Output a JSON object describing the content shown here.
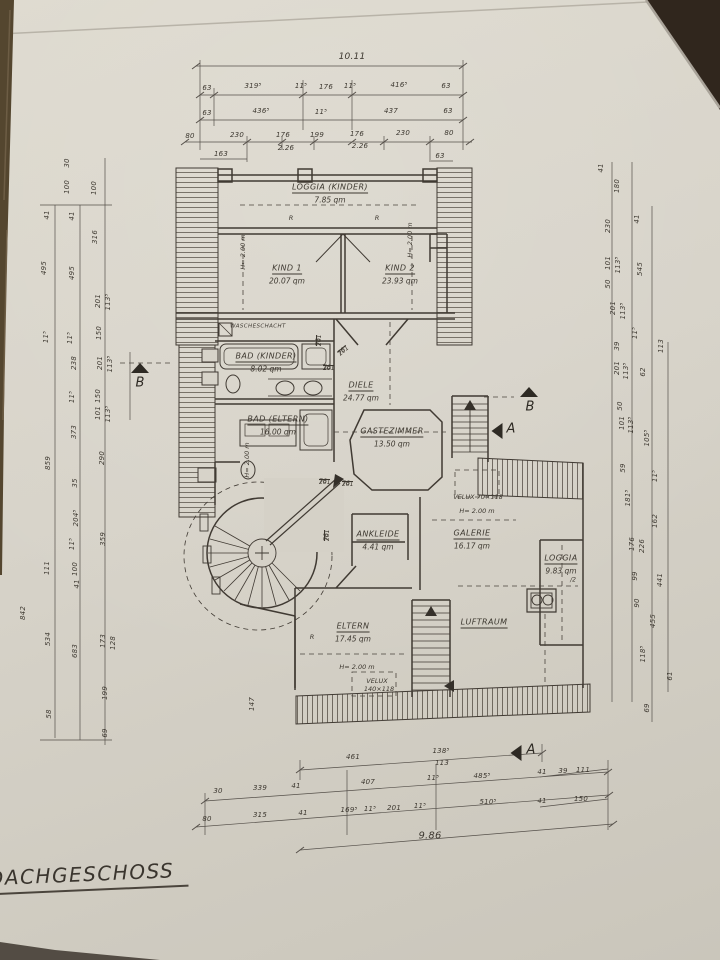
{
  "title": {
    "label": "DACHGESCHOSS"
  },
  "palette": {
    "paper": "#d7d3c9",
    "ink": "#403a33",
    "dim_ink": "#4f4941",
    "wood": "#54462f",
    "corner": "#30261d"
  },
  "rooms": [
    {
      "n": "LOGGIA (KINDER)",
      "a": "7.85 qm",
      "x": 330,
      "y": 188
    },
    {
      "n": "KIND 1",
      "a": "20.07 qm",
      "x": 287,
      "y": 269
    },
    {
      "n": "KIND 2",
      "a": "23.93 qm",
      "x": 400,
      "y": 269
    },
    {
      "n": "WASCHESCHACHT",
      "x": 258,
      "y": 327,
      "s": 5.5,
      "nou": true
    },
    {
      "n": "BAD (KINDER)",
      "a": "8.02 qm",
      "x": 266,
      "y": 357
    },
    {
      "n": "BAD (ELTERN)",
      "a": "16.00 qm",
      "x": 278,
      "y": 420
    },
    {
      "n": "DIELE",
      "a": "24.77 qm",
      "x": 361,
      "y": 386
    },
    {
      "n": "GASTEZIMMER",
      "a": "13.50 qm",
      "x": 392,
      "y": 432
    },
    {
      "n": "ANKLEIDE",
      "a": "4.41 qm",
      "x": 378,
      "y": 535
    },
    {
      "n": "GALERIE",
      "a": "16.17 qm",
      "x": 472,
      "y": 534
    },
    {
      "n": "LOGGIA",
      "a": "9.83 qm",
      "a2": "/2",
      "x": 561,
      "y": 559
    },
    {
      "n": "ELTERN",
      "a": "17.45 qm",
      "x": 353,
      "y": 627
    },
    {
      "n": "LUFTRAUM",
      "x": 484,
      "y": 623
    }
  ],
  "door_dim": {
    "num": "76",
    "den": "201"
  },
  "door_fractions": [
    {
      "x": 316,
      "y": 346,
      "r": 1
    },
    {
      "x": 323,
      "y": 365,
      "r": 0
    },
    {
      "x": 337,
      "y": 352,
      "r": 2
    },
    {
      "x": 319,
      "y": 479,
      "r": 0
    },
    {
      "x": 342,
      "y": 481,
      "r": 0
    },
    {
      "x": 324,
      "y": 541,
      "r": 1
    }
  ],
  "notes": [
    {
      "t": "VELUX 70×118",
      "x": 478,
      "y": 497
    },
    {
      "t": "H= 2.00 m",
      "x": 477,
      "y": 511
    },
    {
      "t": "H= 2.00 m",
      "x": 357,
      "y": 667
    },
    {
      "t": "VELUX",
      "x": 377,
      "y": 681
    },
    {
      "t": "140×118",
      "x": 379,
      "y": 689
    },
    {
      "t": "H= 2.00 m",
      "x": 243,
      "y": 252,
      "r": 1
    },
    {
      "t": "H= 2.00 m",
      "x": 410,
      "y": 240,
      "r": 1
    },
    {
      "t": "H= 2.00 m",
      "x": 247,
      "y": 460,
      "r": 1
    },
    {
      "t": "R",
      "x": 291,
      "y": 218
    },
    {
      "t": "R",
      "x": 377,
      "y": 218
    },
    {
      "t": "R",
      "x": 312,
      "y": 637
    }
  ],
  "dim_labels": [
    [
      "10.11",
      352,
      57,
      0,
      9
    ],
    [
      "63",
      207,
      88
    ],
    [
      "319⁵",
      253,
      86
    ],
    [
      "11⁵",
      301,
      86
    ],
    [
      "176",
      326,
      87
    ],
    [
      "11⁵",
      350,
      86
    ],
    [
      "416⁵",
      399,
      85
    ],
    [
      "63",
      446,
      86
    ],
    [
      "63",
      207,
      113
    ],
    [
      "436⁵",
      261,
      111
    ],
    [
      "11⁵",
      321,
      112
    ],
    [
      "437",
      391,
      111
    ],
    [
      "63",
      448,
      111
    ],
    [
      "80",
      190,
      136
    ],
    [
      "230",
      237,
      135
    ],
    [
      "176",
      283,
      135
    ],
    [
      "199",
      317,
      135
    ],
    [
      "176",
      357,
      134
    ],
    [
      "230",
      403,
      133
    ],
    [
      "80",
      449,
      133
    ],
    [
      "2.26",
      286,
      148
    ],
    [
      "2.26",
      360,
      146
    ],
    [
      "163",
      221,
      154
    ],
    [
      "63",
      440,
      156
    ],
    [
      "461",
      353,
      757
    ],
    [
      "138⁵",
      441,
      751
    ],
    [
      "113",
      442,
      763
    ],
    [
      "30",
      218,
      791
    ],
    [
      "339",
      260,
      788
    ],
    [
      "41",
      296,
      786
    ],
    [
      "407",
      368,
      782
    ],
    [
      "11⁵",
      433,
      778
    ],
    [
      "485⁵",
      482,
      776
    ],
    [
      "41",
      542,
      772
    ],
    [
      "39",
      563,
      771
    ],
    [
      "111",
      583,
      770
    ],
    [
      "80",
      207,
      819
    ],
    [
      "315",
      260,
      815
    ],
    [
      "41",
      303,
      813
    ],
    [
      "169⁵",
      349,
      810
    ],
    [
      "11⁵",
      370,
      809
    ],
    [
      "201",
      394,
      808
    ],
    [
      "11⁵",
      420,
      806
    ],
    [
      "510⁵",
      488,
      802
    ],
    [
      "41",
      542,
      801
    ],
    [
      "150",
      581,
      799
    ],
    [
      "9.86",
      430,
      836,
      0,
      10
    ],
    [
      "30",
      67,
      163,
      1
    ],
    [
      "100",
      67,
      187,
      1
    ],
    [
      "100",
      94,
      188,
      1
    ],
    [
      "41",
      47,
      215,
      1
    ],
    [
      "41",
      72,
      216,
      1
    ],
    [
      "316",
      95,
      237,
      1
    ],
    [
      "495",
      44,
      268,
      1
    ],
    [
      "495",
      72,
      273,
      1
    ],
    [
      "201",
      98,
      301,
      1
    ],
    [
      "113⁵",
      108,
      302,
      1
    ],
    [
      "11⁵",
      46,
      337,
      1
    ],
    [
      "11⁵",
      70,
      338,
      1
    ],
    [
      "150",
      99,
      333,
      1
    ],
    [
      "238",
      74,
      363,
      1
    ],
    [
      "201",
      100,
      363,
      1
    ],
    [
      "113⁵",
      110,
      364,
      1
    ],
    [
      "11⁵",
      72,
      397,
      1
    ],
    [
      "150",
      98,
      396,
      1
    ],
    [
      "101",
      98,
      413,
      1
    ],
    [
      "113⁵",
      108,
      414,
      1
    ],
    [
      "373",
      74,
      432,
      1
    ],
    [
      "859",
      48,
      463,
      1
    ],
    [
      "290",
      102,
      458,
      1
    ],
    [
      "35",
      75,
      483,
      1
    ],
    [
      "204⁵",
      76,
      518,
      1
    ],
    [
      "359",
      103,
      539,
      1
    ],
    [
      "11⁵",
      72,
      544,
      1
    ],
    [
      "111",
      47,
      568,
      1
    ],
    [
      "100",
      75,
      569,
      1
    ],
    [
      "41",
      77,
      584,
      1
    ],
    [
      "842",
      23,
      613,
      1
    ],
    [
      "534",
      48,
      639,
      1
    ],
    [
      "683",
      75,
      651,
      1
    ],
    [
      "173",
      103,
      641,
      1
    ],
    [
      "128",
      113,
      643,
      1
    ],
    [
      "199",
      105,
      693,
      1
    ],
    [
      "58",
      49,
      714,
      1
    ],
    [
      "69",
      105,
      733,
      1
    ],
    [
      "147",
      252,
      704,
      1
    ],
    [
      "41",
      601,
      168,
      1
    ],
    [
      "180",
      617,
      186,
      1
    ],
    [
      "230",
      608,
      226,
      1
    ],
    [
      "41",
      637,
      219,
      1
    ],
    [
      "101",
      608,
      263,
      1
    ],
    [
      "113⁵",
      618,
      265,
      1
    ],
    [
      "545",
      640,
      269,
      1
    ],
    [
      "50",
      608,
      284,
      1
    ],
    [
      "201",
      613,
      308,
      1
    ],
    [
      "113⁵",
      623,
      311,
      1
    ],
    [
      "11⁵",
      635,
      333,
      1
    ],
    [
      "39",
      617,
      346,
      1
    ],
    [
      "113",
      661,
      346,
      1
    ],
    [
      "201",
      617,
      368,
      1
    ],
    [
      "113⁵",
      626,
      371,
      1
    ],
    [
      "62",
      643,
      372,
      1
    ],
    [
      "50",
      620,
      406,
      1
    ],
    [
      "101",
      622,
      423,
      1
    ],
    [
      "113⁵",
      631,
      425,
      1
    ],
    [
      "105⁵",
      647,
      438,
      1
    ],
    [
      "59",
      623,
      468,
      1
    ],
    [
      "11⁵",
      655,
      476,
      1
    ],
    [
      "181⁵",
      628,
      498,
      1
    ],
    [
      "162",
      655,
      521,
      1
    ],
    [
      "176",
      632,
      544,
      1
    ],
    [
      "226",
      642,
      546,
      1
    ],
    [
      "99",
      635,
      576,
      1
    ],
    [
      "441",
      660,
      580,
      1
    ],
    [
      "90",
      637,
      603,
      1
    ],
    [
      "455",
      653,
      621,
      1
    ],
    [
      "118⁵",
      643,
      654,
      1
    ],
    [
      "61",
      670,
      676,
      1
    ],
    [
      "69",
      647,
      708,
      1
    ]
  ],
  "section_markers": [
    {
      "l": "B",
      "x": 140,
      "y": 368,
      "d": "up",
      "lx": 140,
      "ly": 383
    },
    {
      "l": "B",
      "x": 529,
      "y": 392,
      "d": "up",
      "lx": 530,
      "ly": 407
    },
    {
      "l": "A",
      "x": 497,
      "y": 431,
      "d": "left",
      "lx": 511,
      "ly": 429
    },
    {
      "l": "A",
      "x": 516,
      "y": 753,
      "d": "left",
      "lx": 531,
      "ly": 750
    }
  ]
}
